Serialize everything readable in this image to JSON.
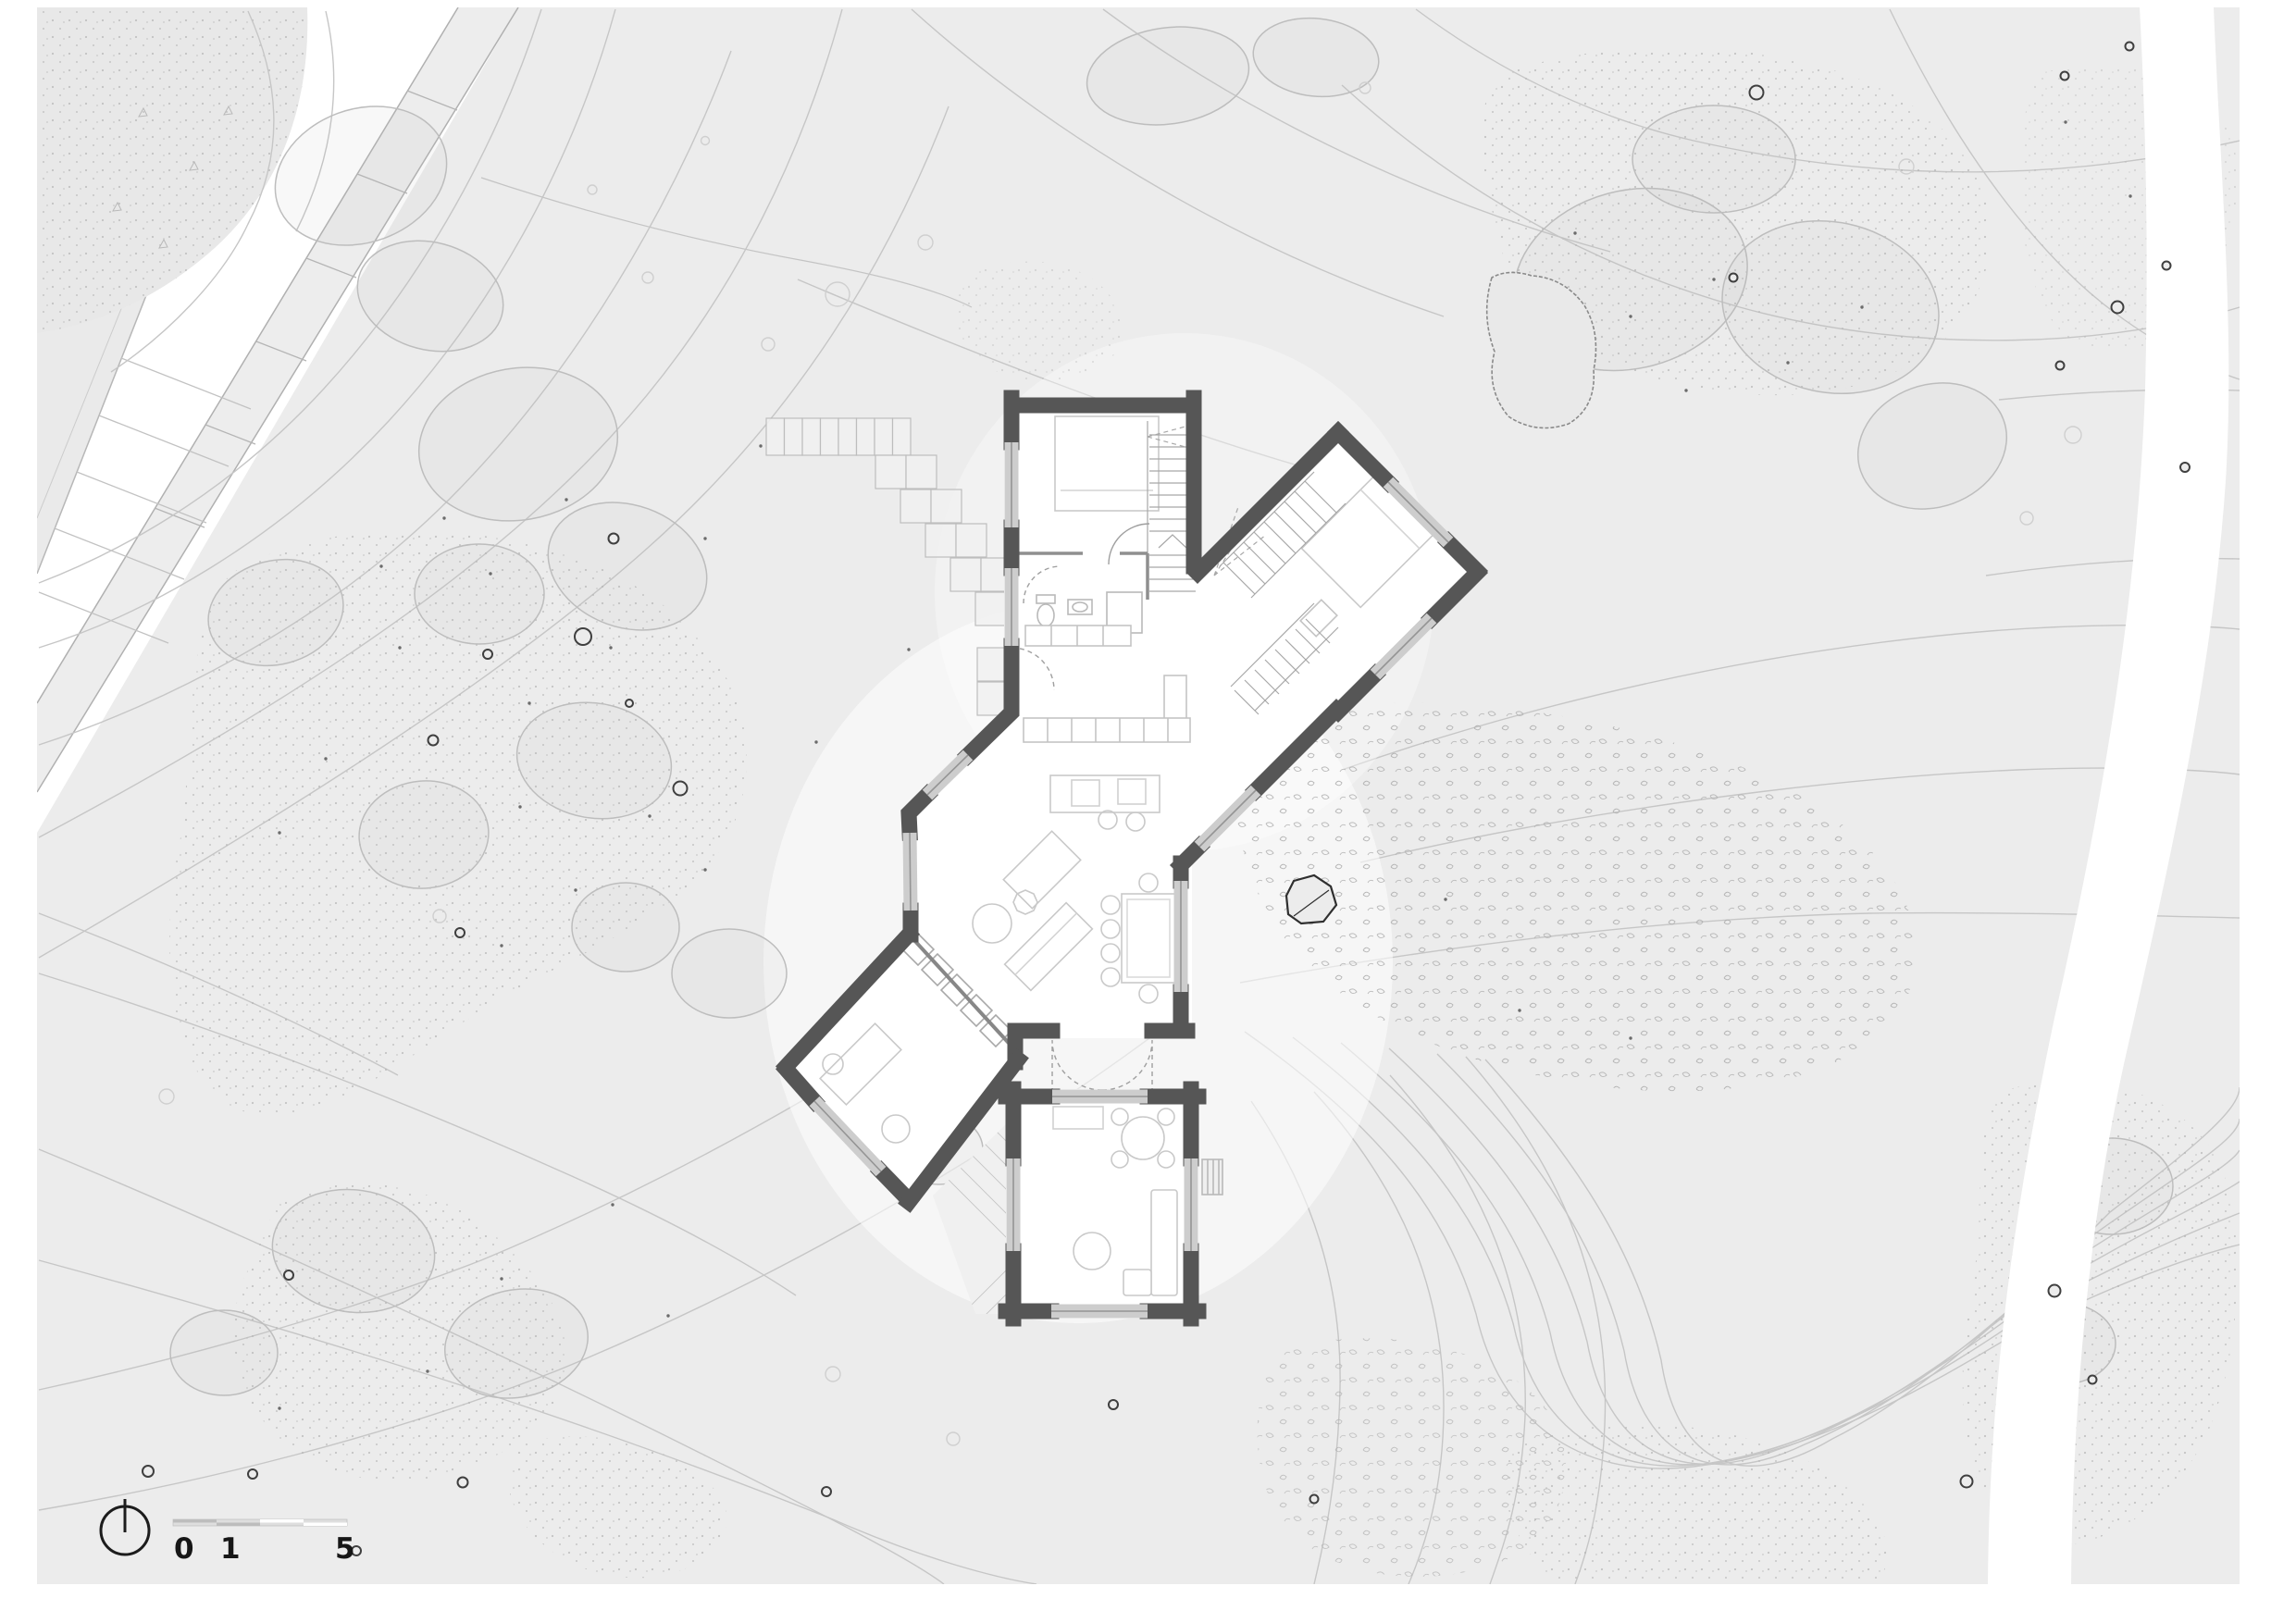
{
  "scale_bar": {
    "labels": [
      "0",
      "1",
      "5"
    ],
    "icon": "north-arrow-icon"
  },
  "colors": {
    "paper": "#ffffff",
    "canvas": "#ececec",
    "wall": "#565656",
    "window": "#cdcdcd",
    "contour": "#c6c6c6",
    "canopy": "#bdbdbd",
    "trunk": "#3f3f3f",
    "rock": "#2f2f2f",
    "furniture": "#c9c9c9"
  }
}
